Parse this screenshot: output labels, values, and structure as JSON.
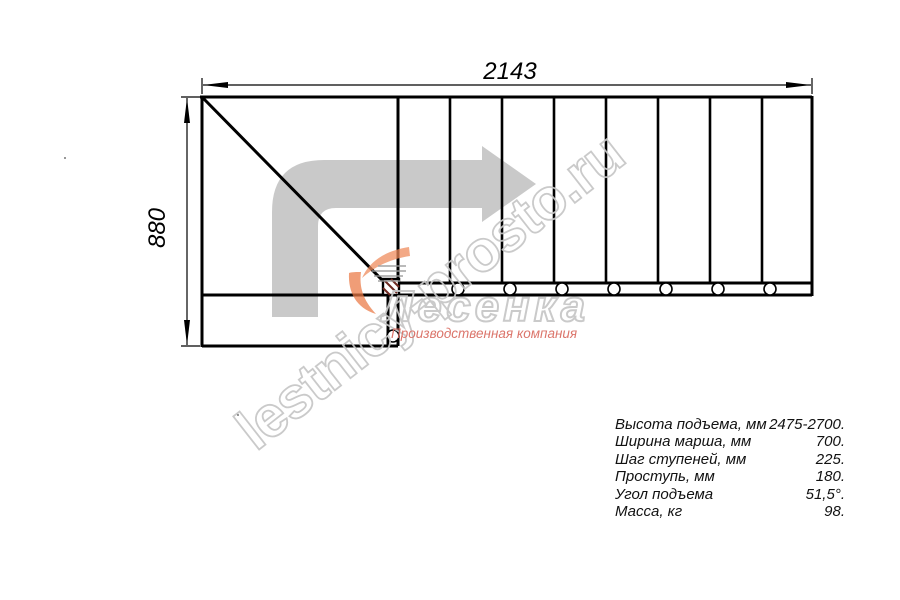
{
  "drawing": {
    "dim_width_label": "2143",
    "dim_height_label": "880"
  },
  "watermark": {
    "diagonal_text": "lestnicy-prosto.ru",
    "logo_text": "Лесенка",
    "logo_subtitle": "Производственная компания"
  },
  "specs": {
    "rows": [
      {
        "label": "Высота подъема, мм",
        "value": "2475-2700."
      },
      {
        "label": "Ширина марша, мм",
        "value": "700."
      },
      {
        "label": "Шаг ступеней, мм",
        "value": "225."
      },
      {
        "label": "Проступь, мм",
        "value": "180."
      },
      {
        "label": "Угол подъема",
        "value": "51,5°."
      },
      {
        "label": "Масса, кг",
        "value": "98."
      }
    ]
  },
  "colors": {
    "line": "#000000",
    "arrow_gray": "#c9c9c9",
    "watermark_gray": "#c6c6c6",
    "subtitle_red": "#d96a5f",
    "swoosh_orange": "#ef8a5a"
  }
}
